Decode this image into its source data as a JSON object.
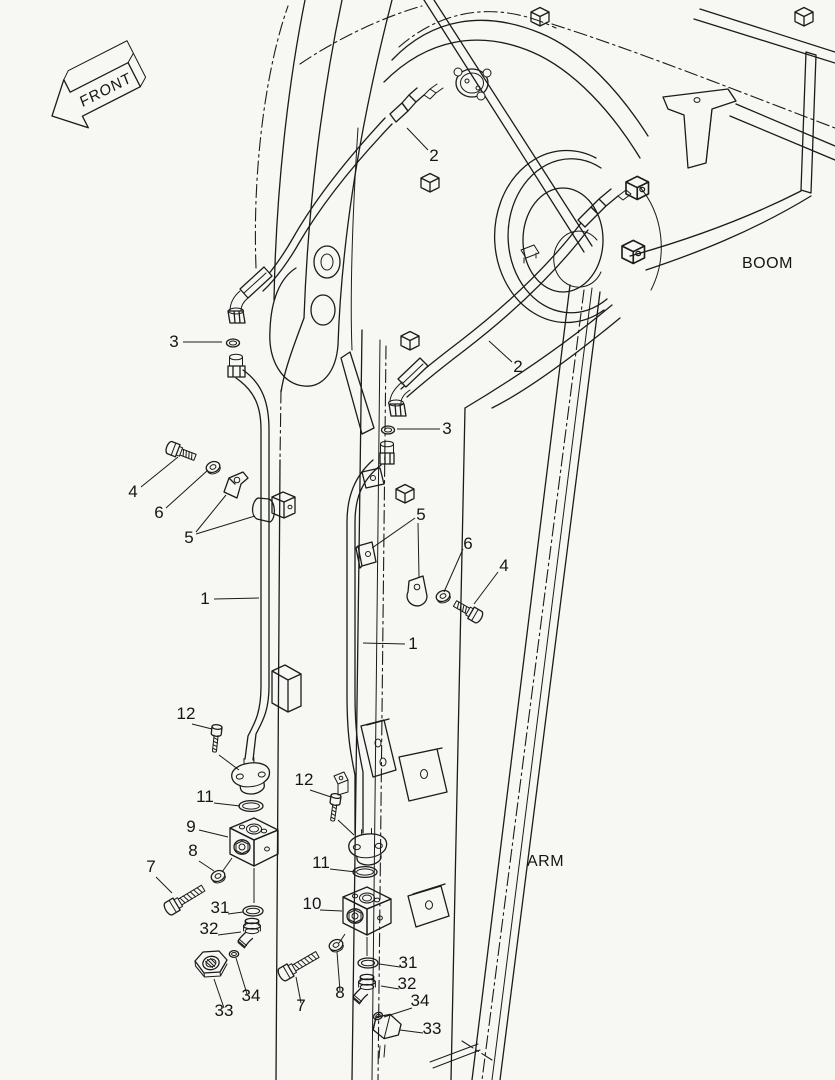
{
  "figure": {
    "type": "exploded-parts-diagram",
    "subject": "excavator boom and arm hydraulic piping"
  },
  "labels": {
    "front": "FRONT",
    "boom": "BOOM",
    "arm": "ARM"
  },
  "callouts": [
    {
      "part": "2"
    },
    {
      "part": "3"
    },
    {
      "part": "2"
    },
    {
      "part": "3"
    },
    {
      "part": "4"
    },
    {
      "part": "6"
    },
    {
      "part": "5"
    },
    {
      "part": "5"
    },
    {
      "part": "6"
    },
    {
      "part": "4"
    },
    {
      "part": "1"
    },
    {
      "part": "1"
    },
    {
      "part": "12"
    },
    {
      "part": "12"
    },
    {
      "part": "11"
    },
    {
      "part": "9"
    },
    {
      "part": "8"
    },
    {
      "part": "11"
    },
    {
      "part": "7"
    },
    {
      "part": "10"
    },
    {
      "part": "31"
    },
    {
      "part": "32"
    },
    {
      "part": "31"
    },
    {
      "part": "32"
    },
    {
      "part": "8"
    },
    {
      "part": "34"
    },
    {
      "part": "34"
    },
    {
      "part": "7"
    },
    {
      "part": "33"
    },
    {
      "part": "33"
    }
  ],
  "parts_visible": [
    "1",
    "2",
    "3",
    "4",
    "5",
    "6",
    "7",
    "8",
    "9",
    "10",
    "11",
    "12",
    "31",
    "32",
    "33",
    "34"
  ],
  "colors": {
    "ink": "#1b1b1b",
    "background": "#f7f7f4",
    "text": "#151515"
  }
}
